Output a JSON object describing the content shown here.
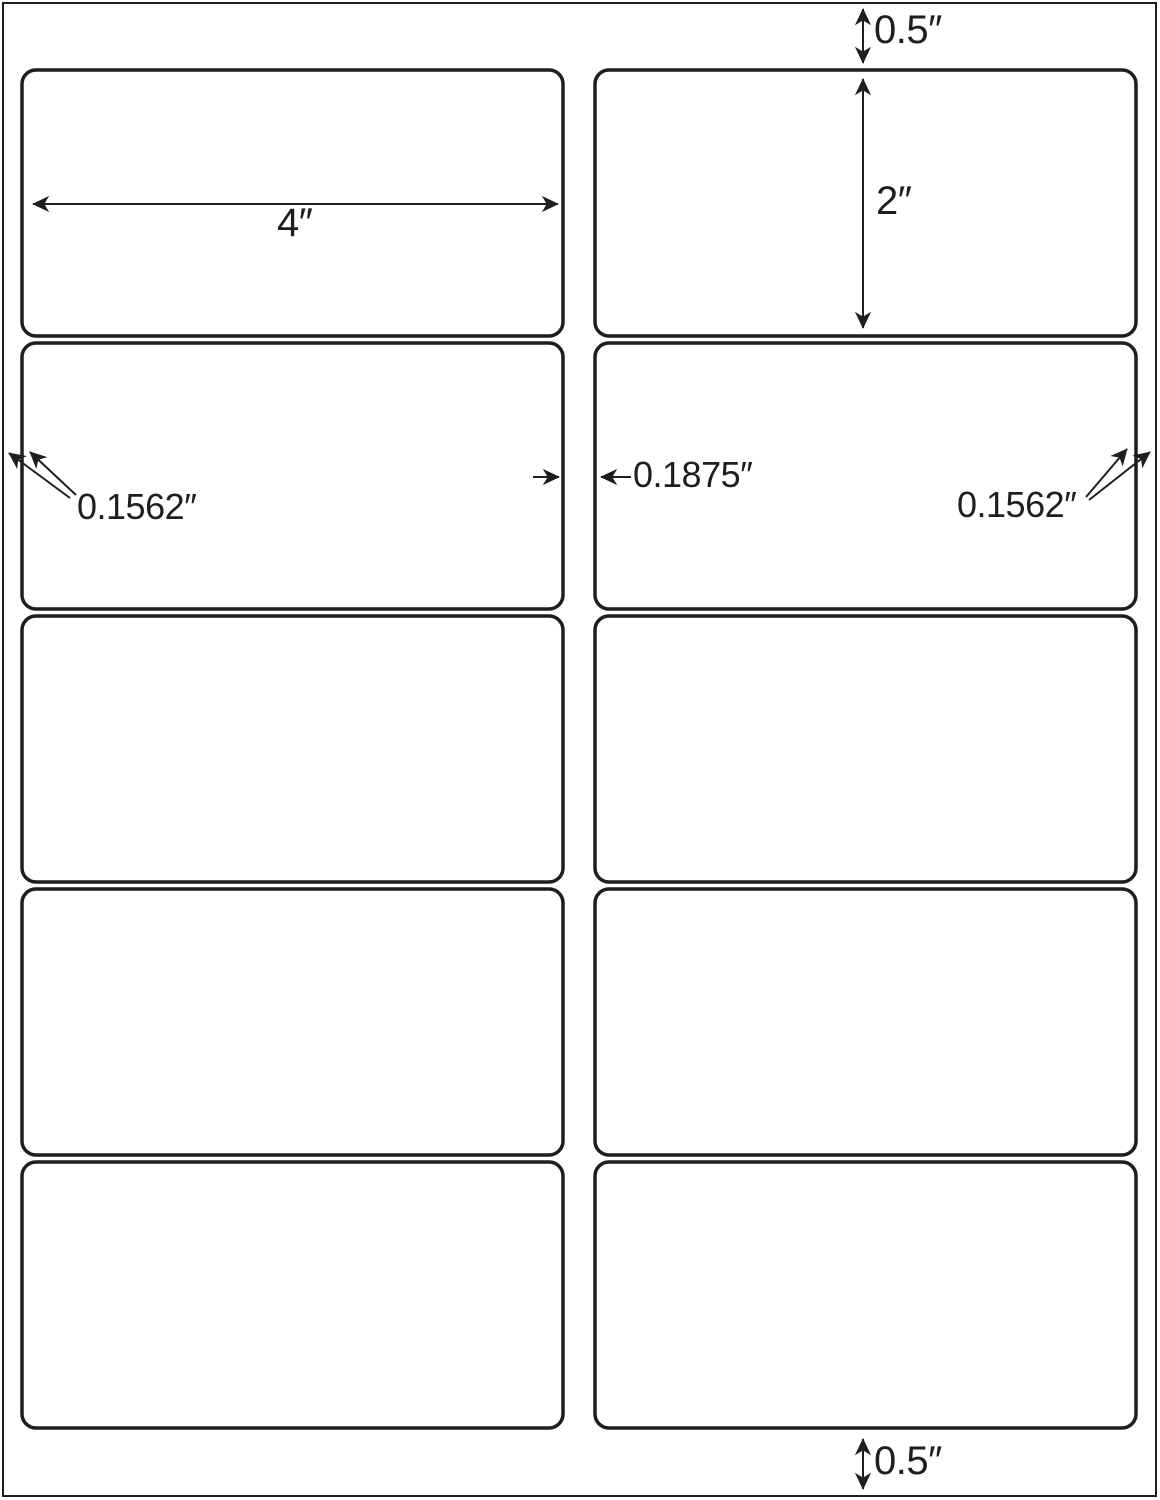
{
  "sheet": {
    "grid": {
      "rows": 5,
      "columns": 2,
      "label_count": 10
    }
  },
  "annotations": {
    "top_margin": "0.5″",
    "bottom_margin": "0.5″",
    "label_width": "4″",
    "label_height": "2″",
    "left_margin": "0.1562″",
    "right_margin": "0.1562″",
    "column_gap": "0.1875″"
  },
  "colors": {
    "stroke": "#1e1e1e",
    "background": "#ffffff"
  }
}
